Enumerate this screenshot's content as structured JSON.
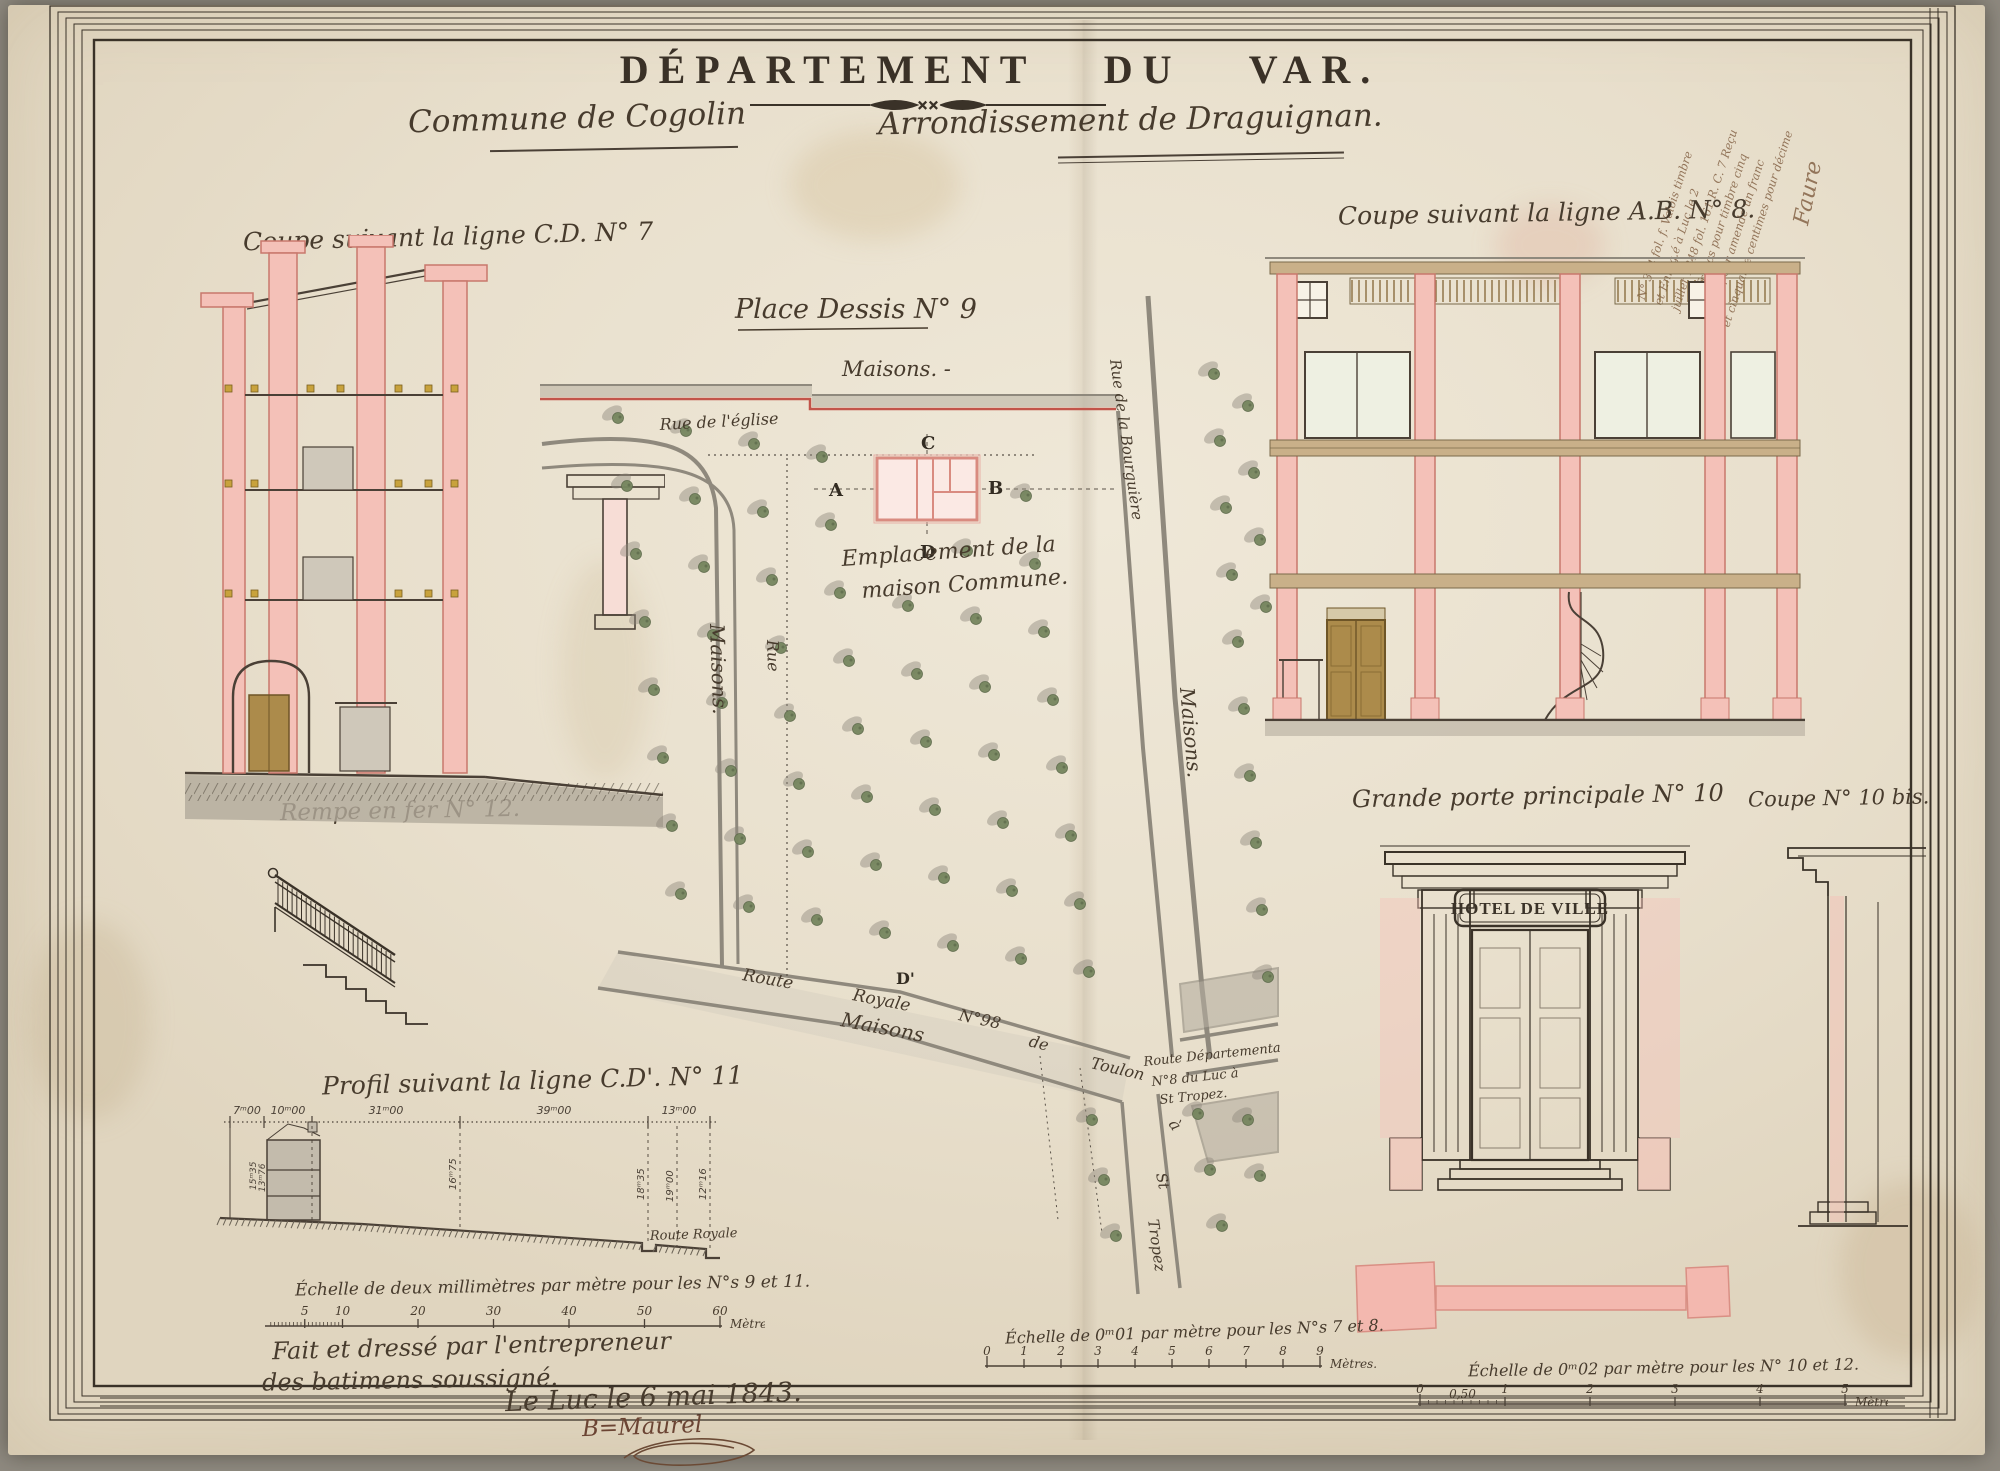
{
  "header": {
    "title": "DÉPARTEMENT DU VAR.",
    "divider_marks": "✕✕",
    "commune": "Commune de Cogolin",
    "arrondissement": "Arrondissement de Draguignan."
  },
  "labels": {
    "coupe7": "Coupe suivant la ligne C.D. N° 7",
    "coupe8": "Coupe suivant la ligne A.B. N° 8.",
    "place": "Place Dessis  N° 9",
    "rempe": "Rempe en fer N° 12.",
    "profil": "Profil suivant la ligne C.D'. N° 11",
    "porte": "Grande porte principale N° 10",
    "coupe10bis": "Coupe N° 10 bis.",
    "hotel_sign": "HOTEL DE VILLE"
  },
  "plan": {
    "maisons_top": "Maisons. -",
    "rue_eglise": "Rue de l'église",
    "maisons_left": "Maisons.",
    "rue_left": "Rue",
    "maisons_right": "Maisons.",
    "rue_bourguiere": "Rue de la Bourguière",
    "emplacement_1": "Emplacement de la",
    "emplacement_2": "maison Commune.",
    "marker_a": "A",
    "marker_b": "B",
    "marker_c": "C",
    "marker_d": "D",
    "marker_d2": "D'",
    "route_words": [
      "Route",
      "Royale",
      "N°98",
      "de",
      "Toulon",
      "à",
      "St",
      "Tropez"
    ],
    "maisons_bottom": "Maisons",
    "route_dep_1": "Route Départementale",
    "route_dep_2": "N°8 du Luc à",
    "route_dep_3": "St Tropez."
  },
  "profil": {
    "dims_horizontal": [
      "7ᵐ00",
      "10ᵐ00",
      "31ᵐ00",
      "39ᵐ00",
      "13ᵐ00"
    ],
    "dims_vertical": [
      "15ᵐ35",
      "13ᵐ76",
      "16ᵐ75",
      "18ᵐ35",
      "19ᵐ00",
      "12ᵐ16"
    ],
    "route_royale": "Route Royale"
  },
  "scales": {
    "s1": {
      "caption": "Échelle de deux millimètres par mètre pour les N°s 9 et 11.",
      "ticks": [
        "5",
        "10",
        "20",
        "30",
        "40",
        "50",
        "60"
      ],
      "tick_values": [
        5,
        10,
        20,
        30,
        40,
        50,
        60
      ],
      "max": 60,
      "comb_to": 10,
      "comb_step": 0.5,
      "unit": "Mètres."
    },
    "s2": {
      "caption": "Échelle de 0ᵐ01 par mètre pour les N°s 7 et 8.",
      "ticks": [
        "0",
        "1",
        "2",
        "3",
        "4",
        "5",
        "6",
        "7",
        "8",
        "9"
      ],
      "tick_values": [
        0,
        1,
        2,
        3,
        4,
        5,
        6,
        7,
        8,
        9
      ],
      "max": 9,
      "unit": "Mètres."
    },
    "s3": {
      "caption": "Échelle de 0ᵐ02 par mètre pour les N° 10 et 12.",
      "ticks": [
        "0",
        "1",
        "2",
        "3",
        "4",
        "5"
      ],
      "tick_values": [
        0,
        1,
        2,
        3,
        4,
        5
      ],
      "max": 5,
      "comb_to": 1,
      "comb_step": 0.1,
      "half_label": "0,50",
      "unit": "Mètres."
    }
  },
  "signature": {
    "line1": "Fait et dressé par l'entrepreneur",
    "line2": "des batimens soussigné.",
    "line3": "Le Luc le 6 mai 1843.",
    "line4": "B=Maurel"
  },
  "corner_note": {
    "lines": [
      "N° 394 fol. f. Valois timbre",
      "et Enreg.é à Luc le 2",
      "juillet 1848 fol. 161 R. C. 7 Reçu",
      "deux francs pour timbre cinq",
      "francs pour amende un franc",
      "et cinquante centimes pour décime"
    ],
    "signature": "Faure"
  },
  "colors": {
    "paper": "#e9e1cf",
    "ink": "#4a4036",
    "pink_wall": "#f4c1b8",
    "pink_line": "#c8786c",
    "red_line": "#c2544a",
    "wood": "#ac8b4b",
    "tan_beam": "#c9b089",
    "tree_green": "#76865f",
    "street_gray": "#8f897d",
    "gold_joist": "#c8a23c"
  }
}
